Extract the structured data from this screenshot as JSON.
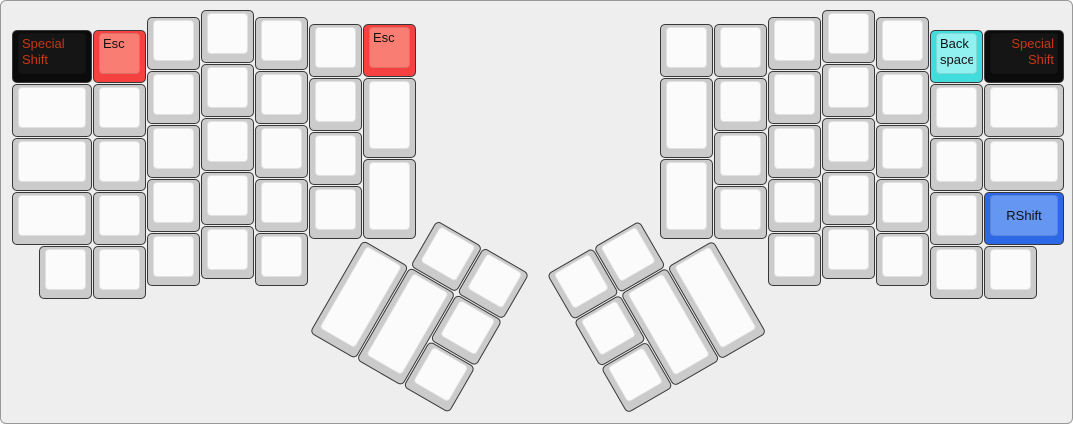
{
  "canvas": {
    "width": 1073,
    "height": 424,
    "background": "#eeeeee",
    "border_color": "#999999"
  },
  "palettes": {
    "white": {
      "base": "#cbcbcb",
      "top": "#fbfbfb",
      "text": "#111111"
    },
    "red": {
      "base": "#f54140",
      "top": "#fa7d73",
      "text": "#111111"
    },
    "black": {
      "base": "#0b0b0b",
      "top": "#151515",
      "text": "#c83719"
    },
    "cyan": {
      "base": "#41dcdc",
      "top": "#91f0f0",
      "text": "#111111"
    },
    "blue": {
      "base": "#2d69e6",
      "top": "#6496f2",
      "text": "#111111"
    }
  },
  "keyboard": {
    "name": "ergodox-layout",
    "unit_px": 54,
    "pad_x": 11,
    "pad_y": 9,
    "keys": [
      {
        "id": "key-special-shift-left",
        "x": 0,
        "y": 0.375,
        "w": 1.5,
        "color": "black",
        "label": "Special\nShift",
        "align": "tl"
      },
      {
        "id": "key-blank",
        "x": 0,
        "y": 1.375,
        "w": 1.5
      },
      {
        "id": "key-blank",
        "x": 0,
        "y": 2.375,
        "w": 1.5
      },
      {
        "id": "key-blank",
        "x": 0,
        "y": 3.375,
        "w": 1.5
      },
      {
        "id": "key-blank",
        "x": 0.5,
        "y": 4.375
      },
      {
        "id": "key-esc-left-top",
        "x": 1.5,
        "y": 0.375,
        "color": "red",
        "label": "Esc",
        "align": "tl"
      },
      {
        "id": "key-blank",
        "x": 1.5,
        "y": 1.375
      },
      {
        "id": "key-blank",
        "x": 1.5,
        "y": 2.375
      },
      {
        "id": "key-blank",
        "x": 1.5,
        "y": 3.375
      },
      {
        "id": "key-blank",
        "x": 1.5,
        "y": 4.375
      },
      {
        "id": "key-blank",
        "x": 2.5,
        "y": 0.125
      },
      {
        "id": "key-blank",
        "x": 2.5,
        "y": 1.125
      },
      {
        "id": "key-blank",
        "x": 2.5,
        "y": 2.125
      },
      {
        "id": "key-blank",
        "x": 2.5,
        "y": 3.125
      },
      {
        "id": "key-blank",
        "x": 2.5,
        "y": 4.125
      },
      {
        "id": "key-blank",
        "x": 3.5,
        "y": 0
      },
      {
        "id": "key-blank",
        "x": 3.5,
        "y": 1
      },
      {
        "id": "key-blank",
        "x": 3.5,
        "y": 2
      },
      {
        "id": "key-blank",
        "x": 3.5,
        "y": 3
      },
      {
        "id": "key-blank",
        "x": 3.5,
        "y": 4
      },
      {
        "id": "key-blank",
        "x": 4.5,
        "y": 0.125
      },
      {
        "id": "key-blank",
        "x": 4.5,
        "y": 1.125
      },
      {
        "id": "key-blank",
        "x": 4.5,
        "y": 2.125
      },
      {
        "id": "key-blank",
        "x": 4.5,
        "y": 3.125
      },
      {
        "id": "key-blank",
        "x": 4.5,
        "y": 4.125
      },
      {
        "id": "key-blank",
        "x": 5.5,
        "y": 0.25
      },
      {
        "id": "key-blank",
        "x": 5.5,
        "y": 1.25
      },
      {
        "id": "key-blank",
        "x": 5.5,
        "y": 2.25
      },
      {
        "id": "key-blank",
        "x": 5.5,
        "y": 3.25
      },
      {
        "id": "key-esc-left-inner",
        "x": 6.5,
        "y": 0.25,
        "color": "red",
        "label": "Esc",
        "align": "tl"
      },
      {
        "id": "key-blank",
        "x": 6.5,
        "y": 1.25,
        "h": 1.5
      },
      {
        "id": "key-blank",
        "x": 6.5,
        "y": 2.75,
        "h": 1.5
      },
      {
        "id": "key-blank-thumb-left",
        "x": 7.5,
        "y": 3.25,
        "r": 30,
        "rx": 6.5,
        "ry": 4.25
      },
      {
        "id": "key-blank-thumb-left",
        "x": 8.5,
        "y": 3.25,
        "r": 30,
        "rx": 6.5,
        "ry": 4.25
      },
      {
        "id": "key-blank-thumb-left",
        "x": 6.5,
        "y": 4.25,
        "h": 2,
        "r": 30,
        "rx": 6.5,
        "ry": 4.25
      },
      {
        "id": "key-blank-thumb-left",
        "x": 7.5,
        "y": 4.25,
        "h": 2,
        "r": 30,
        "rx": 6.5,
        "ry": 4.25
      },
      {
        "id": "key-blank-thumb-left",
        "x": 8.5,
        "y": 4.25,
        "r": 30,
        "rx": 6.5,
        "ry": 4.25
      },
      {
        "id": "key-blank-thumb-left",
        "x": 8.5,
        "y": 5.25,
        "r": 30,
        "rx": 6.5,
        "ry": 4.25
      },
      {
        "id": "key-blank-thumb-right",
        "x": 10,
        "y": 3.25,
        "r": -30,
        "rx": 13,
        "ry": 4.25
      },
      {
        "id": "key-blank-thumb-right",
        "x": 11,
        "y": 3.25,
        "r": -30,
        "rx": 13,
        "ry": 4.25
      },
      {
        "id": "key-blank-thumb-right",
        "x": 10,
        "y": 4.25,
        "r": -30,
        "rx": 13,
        "ry": 4.25
      },
      {
        "id": "key-blank-thumb-right",
        "x": 11,
        "y": 4.25,
        "h": 2,
        "r": -30,
        "rx": 13,
        "ry": 4.25
      },
      {
        "id": "key-blank-thumb-right",
        "x": 12,
        "y": 4.25,
        "h": 2,
        "r": -30,
        "rx": 13,
        "ry": 4.25
      },
      {
        "id": "key-blank-thumb-right",
        "x": 10,
        "y": 5.25,
        "r": -30,
        "rx": 13,
        "ry": 4.25
      },
      {
        "id": "key-blank",
        "x": 12,
        "y": 0.25
      },
      {
        "id": "key-blank",
        "x": 12,
        "y": 1.25,
        "h": 1.5
      },
      {
        "id": "key-blank",
        "x": 12,
        "y": 2.75,
        "h": 1.5
      },
      {
        "id": "key-blank",
        "x": 13,
        "y": 0.25
      },
      {
        "id": "key-blank",
        "x": 13,
        "y": 1.25
      },
      {
        "id": "key-blank",
        "x": 13,
        "y": 2.25
      },
      {
        "id": "key-blank",
        "x": 13,
        "y": 3.25
      },
      {
        "id": "key-blank",
        "x": 14,
        "y": 0.125
      },
      {
        "id": "key-blank",
        "x": 14,
        "y": 1.125
      },
      {
        "id": "key-blank",
        "x": 14,
        "y": 2.125
      },
      {
        "id": "key-blank",
        "x": 14,
        "y": 3.125
      },
      {
        "id": "key-blank",
        "x": 14,
        "y": 4.125
      },
      {
        "id": "key-blank",
        "x": 15,
        "y": 0
      },
      {
        "id": "key-blank",
        "x": 15,
        "y": 1
      },
      {
        "id": "key-blank",
        "x": 15,
        "y": 2
      },
      {
        "id": "key-blank",
        "x": 15,
        "y": 3
      },
      {
        "id": "key-blank",
        "x": 15,
        "y": 4
      },
      {
        "id": "key-blank",
        "x": 16,
        "y": 0.125
      },
      {
        "id": "key-blank",
        "x": 16,
        "y": 1.125
      },
      {
        "id": "key-blank",
        "x": 16,
        "y": 2.125
      },
      {
        "id": "key-blank",
        "x": 16,
        "y": 3.125
      },
      {
        "id": "key-blank",
        "x": 16,
        "y": 4.125
      },
      {
        "id": "key-backspace",
        "x": 17,
        "y": 0.375,
        "color": "cyan",
        "label": "Back\nspace",
        "align": "tl"
      },
      {
        "id": "key-blank",
        "x": 17,
        "y": 1.375
      },
      {
        "id": "key-blank",
        "x": 17,
        "y": 2.375
      },
      {
        "id": "key-blank",
        "x": 17,
        "y": 3.375
      },
      {
        "id": "key-blank",
        "x": 17,
        "y": 4.375
      },
      {
        "id": "key-special-shift-right",
        "x": 18,
        "y": 0.375,
        "w": 1.5,
        "color": "black",
        "label": "Special\nShift",
        "align": "tr"
      },
      {
        "id": "key-blank",
        "x": 18,
        "y": 1.375,
        "w": 1.5
      },
      {
        "id": "key-blank",
        "x": 18,
        "y": 2.375,
        "w": 1.5
      },
      {
        "id": "key-rshift",
        "x": 18,
        "y": 3.375,
        "w": 1.5,
        "color": "blue",
        "label": "RShift",
        "align": "c"
      },
      {
        "id": "key-blank",
        "x": 18,
        "y": 4.375
      }
    ]
  }
}
